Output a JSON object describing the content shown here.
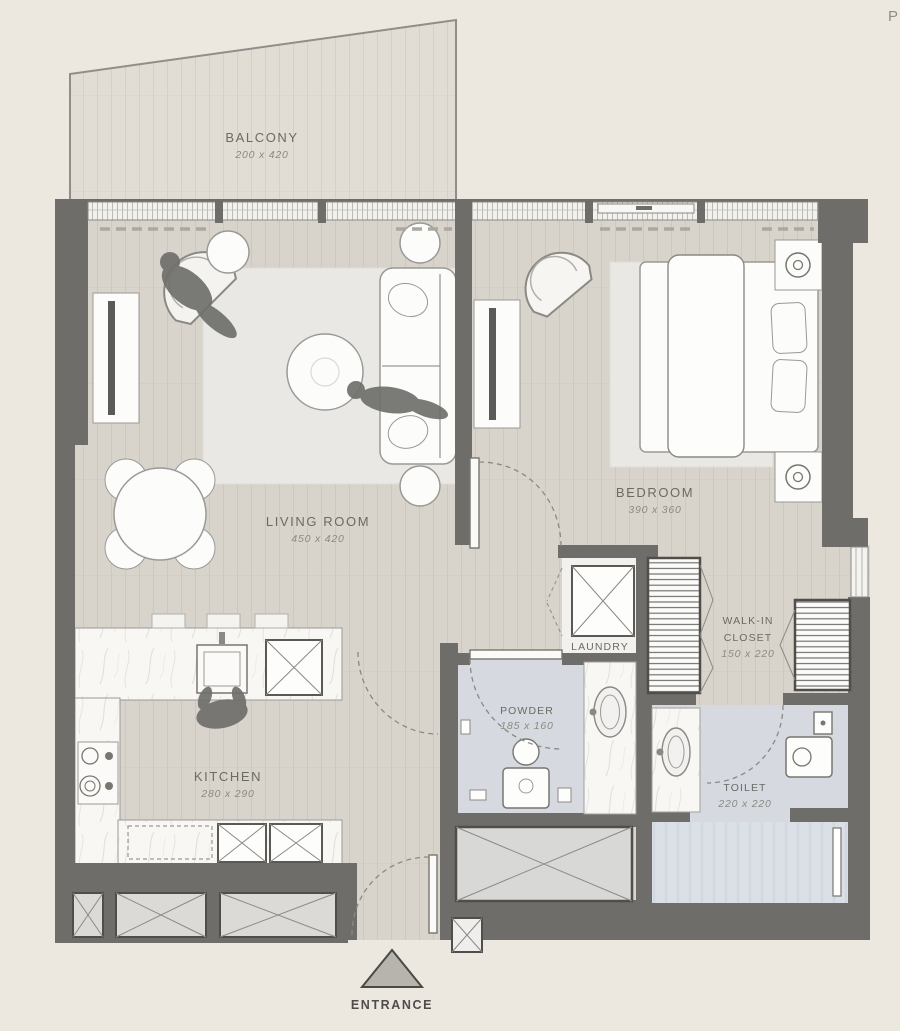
{
  "meta": {
    "corner_text": "P",
    "plan_type": "apartment-floor-plan"
  },
  "rooms": {
    "balcony": {
      "name": "BALCONY",
      "dims": "200 x 420"
    },
    "living_room": {
      "name": "LIVING ROOM",
      "dims": "450 x 420"
    },
    "bedroom": {
      "name": "BEDROOM",
      "dims": "390 x 360"
    },
    "kitchen": {
      "name": "KITCHEN",
      "dims": "280 x 290"
    },
    "walk_in_closet": {
      "name_line1": "WALK-IN",
      "name_line2": "CLOSET",
      "dims": "150 x 220"
    },
    "laundry": {
      "name": "LAUNDRY"
    },
    "powder": {
      "name": "POWDER",
      "dims": "185 x 160"
    },
    "toilet": {
      "name": "TOILET",
      "dims": "220 x 220"
    }
  },
  "entrance": {
    "label": "ENTRANCE"
  },
  "colors": {
    "background": "#ECE8E0",
    "wall": "#6E6D6A",
    "wood_floor": "#D9D4CB",
    "balcony_floor": "#E1DDD5",
    "wet_floor": "#D6DAE0",
    "shower_floor": "#DBE0E6",
    "rug": "#E9E8E4",
    "marble": "#F8F7F4",
    "furniture": "#FCFCFA",
    "silhouette": "#6F6F6C",
    "label_text": "#6B6A63",
    "dims_text": "#8B8A82"
  }
}
